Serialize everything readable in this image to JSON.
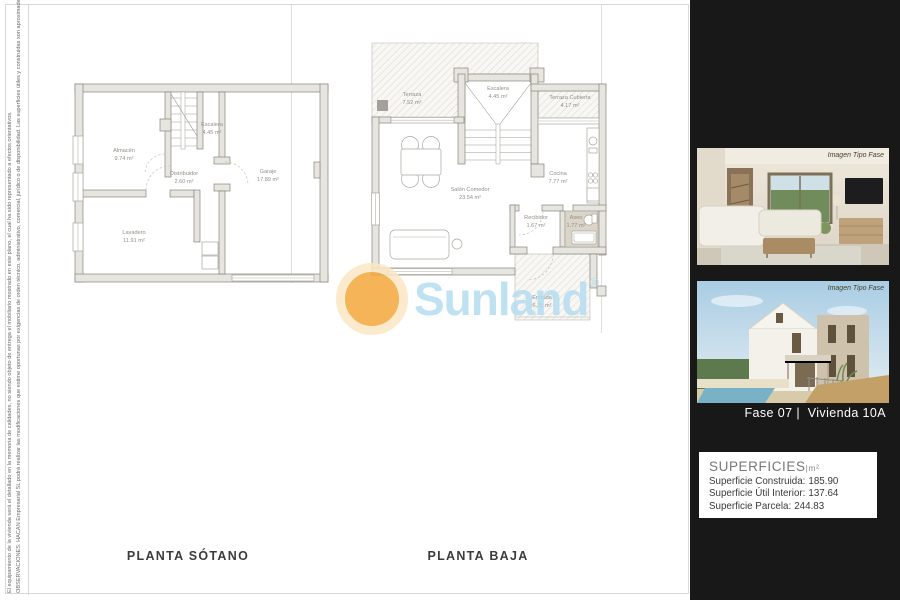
{
  "page": {
    "disclaimer_equipamiento": "El equipamiento de la vivienda será el detallado en la memoria de calidades, no siendo objeto de entrega el mobiliario mostrado en este plano, el cual ha sido representado a efectos orientativos.",
    "disclaimer_observaciones": "OBSERVACIONES: HACAN Empresarial SL podrá realizar las modificaciones que estime oportunas por exigencias de orden técnico, administrativo, comercial, jurídico o de disponibilidad. Las superficies útiles y construidas son aproximadas."
  },
  "plans": {
    "sotano": {
      "title": "PLANTA SÓTANO",
      "rooms": [
        {
          "name": "Almacén",
          "area": "9.74 m²"
        },
        {
          "name": "Escalera",
          "area": "4.45 m²"
        },
        {
          "name": "Distribuidor",
          "area": "2.60 m²"
        },
        {
          "name": "Garaje",
          "area": "17.89 m²"
        },
        {
          "name": "Lavadero",
          "area": "11.91 m²"
        }
      ]
    },
    "baja": {
      "title": "PLANTA BAJA",
      "rooms": [
        {
          "name": "Terraza",
          "area": "7.52 m²"
        },
        {
          "name": "Escalera",
          "area": "4.45 m²"
        },
        {
          "name": "Terraza Cubierta",
          "area": "4.17 m²"
        },
        {
          "name": "Salón Comedor",
          "area": "23.54 m²"
        },
        {
          "name": "Cocina",
          "area": "7.77 m²"
        },
        {
          "name": "Recibidor",
          "area": "1.67 m²"
        },
        {
          "name": "Aseo",
          "area": "1.77 m²"
        },
        {
          "name": "Entrada",
          "area": "6.25 m²"
        }
      ]
    }
  },
  "watermark": {
    "brand": "Sunland",
    "registered": "®"
  },
  "sidebar": {
    "photos": [
      {
        "caption": "Imagen Tipo Fase"
      },
      {
        "caption": "Imagen Tipo Fase"
      }
    ],
    "phase_label": "Fase 07 |  Vivienda 10A",
    "superficies": {
      "title": "SUPERFICIES",
      "unit": "|m²",
      "rows": [
        {
          "label": "Superficie Construida:",
          "value": "185.90"
        },
        {
          "label": "Superficie Útil Interior:",
          "value": "137.64"
        },
        {
          "label": "Superficie Parcela:",
          "value": "244.83"
        }
      ]
    }
  },
  "colors": {
    "sun_orange": "#f5a73b",
    "sun_ring": "#fbe7c4",
    "brand_blue": "#b5ddf0",
    "sidebar_bg": "#181818",
    "wall_fill": "#e7e5df",
    "aseo_fill": "#dbd4c8"
  }
}
